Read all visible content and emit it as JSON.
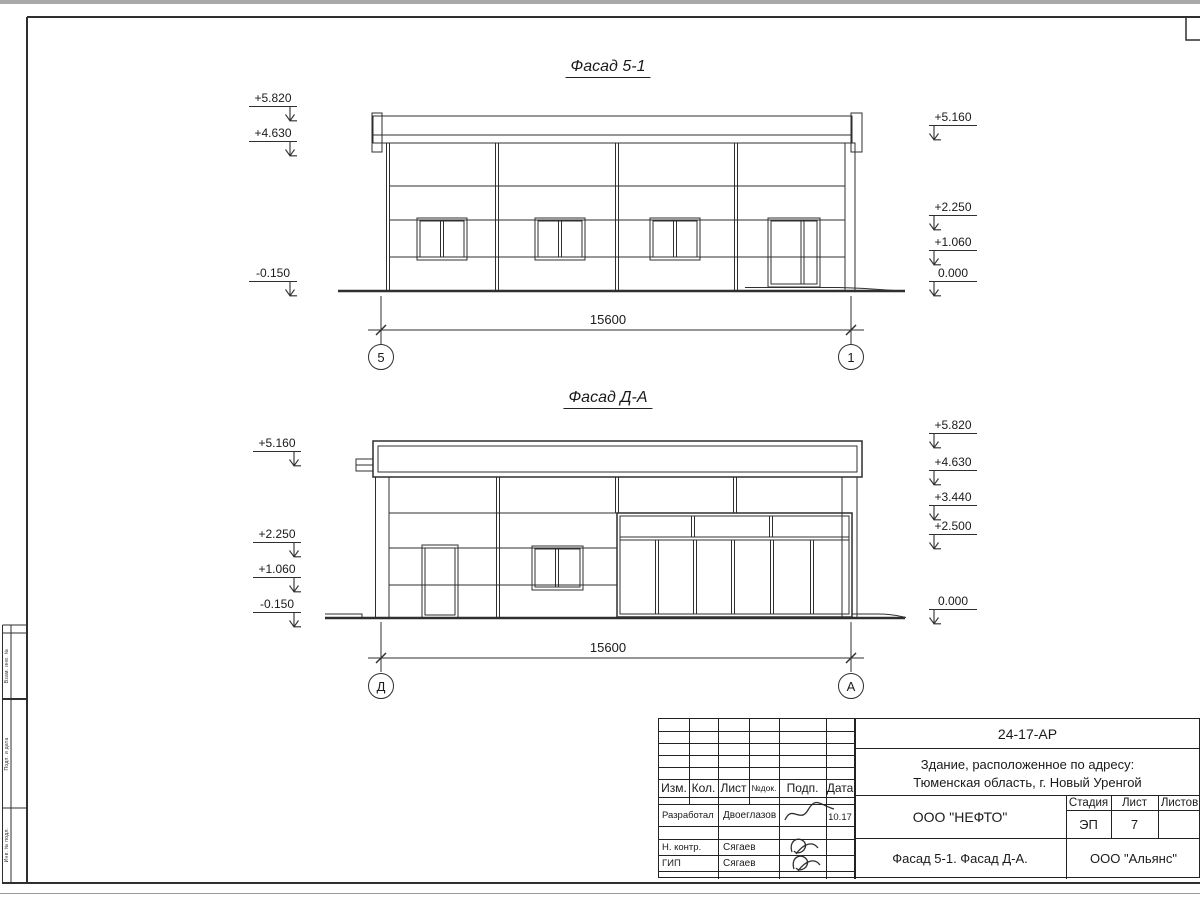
{
  "facade1": {
    "title": "Фасад 5-1",
    "dimension": "15600",
    "axis_left": "5",
    "axis_right": "1",
    "marks_left": [
      {
        "value": "+5.820"
      },
      {
        "value": "+4.630"
      },
      {
        "value": "-0.150"
      }
    ],
    "marks_right": [
      {
        "value": "+5.160"
      },
      {
        "value": "+2.250"
      },
      {
        "value": "+1.060"
      },
      {
        "value": "0.000"
      }
    ]
  },
  "facade2": {
    "title": "Фасад Д-А",
    "dimension": "15600",
    "axis_left": "Д",
    "axis_right": "А",
    "marks_left": [
      {
        "value": "+5.160"
      },
      {
        "value": "+2.250"
      },
      {
        "value": "+1.060"
      },
      {
        "value": "-0.150"
      }
    ],
    "marks_right": [
      {
        "value": "+5.820"
      },
      {
        "value": "+4.630"
      },
      {
        "value": "+3.440"
      },
      {
        "value": "+2.500"
      },
      {
        "value": "0.000"
      }
    ]
  },
  "title_block": {
    "doc_number": "24-17-АР",
    "object_line1": "Здание, расположенное по адресу:",
    "object_line2": "Тюменская область, г. Новый Уренгой",
    "columns": {
      "izm": "Изм.",
      "kol": "Кол.",
      "list": "Лист",
      "ndok": "№док.",
      "podp": "Подп.",
      "data": "Дата"
    },
    "rows": [
      {
        "role": "Разработал",
        "name": "Двоеглазов",
        "date": "10.17"
      },
      {
        "role": "Н. контр.",
        "name": "Сягаев",
        "date": ""
      },
      {
        "role": "ГИП",
        "name": "Сягаев",
        "date": ""
      }
    ],
    "stage_label": "Стадия",
    "sheet_label": "Лист",
    "sheets_label": "Листов",
    "stage": "ЭП",
    "sheet": "7",
    "sheets": "",
    "company": "ООО \"НЕФТО\"",
    "sheet_title": "Фасад 5-1. Фасад Д-А.",
    "org": "ООО \"Альянс\""
  },
  "left_margin": {
    "cells": [
      "Взам. инв. №",
      "Подп. и дата",
      "Инв. № подл."
    ]
  }
}
